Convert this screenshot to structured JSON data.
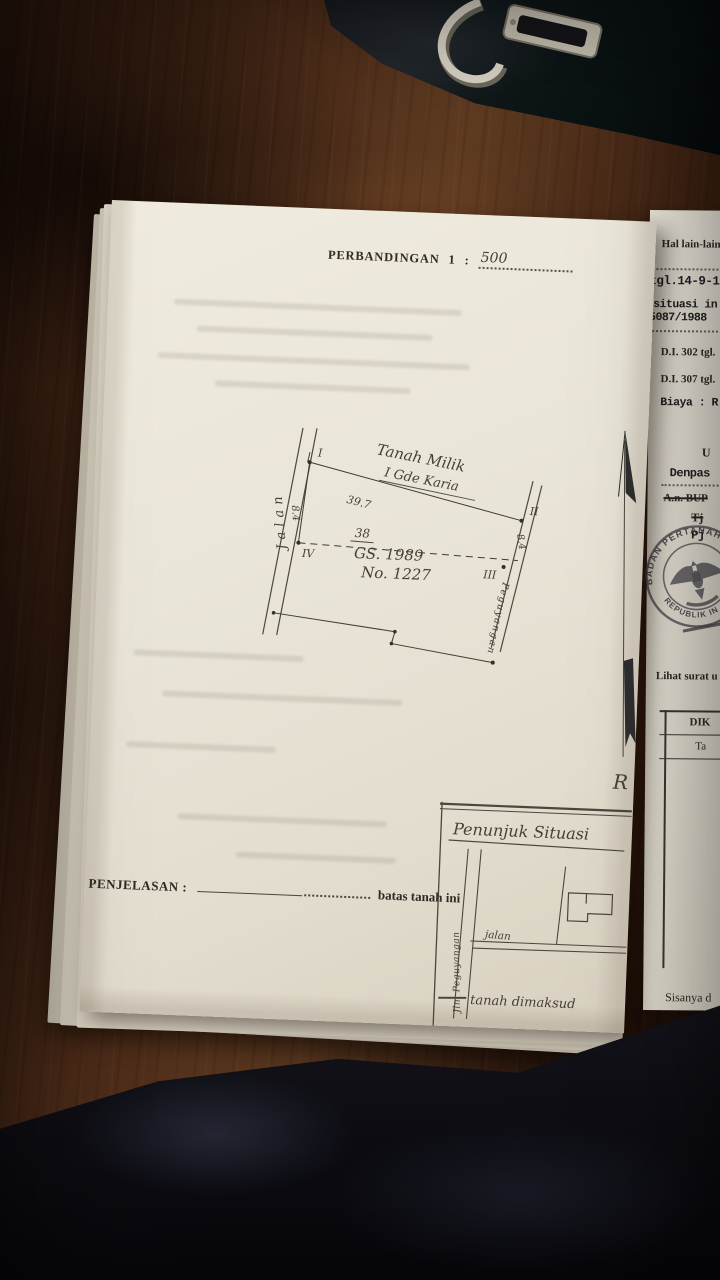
{
  "main_page": {
    "scale": {
      "label": "PERBANDINGAN",
      "ratio": "1",
      "colon": ":",
      "value": "500"
    },
    "sketch": {
      "road_label": "Jalan",
      "owner_line1": "Tanah Milik",
      "owner_line2": "I Gde Karia",
      "dim_top": "39.7",
      "dim_left": "8.4",
      "dim_mid": "38",
      "dim_right": "8.4",
      "ref_line1": "GS. 1989",
      "ref_line2": "No. 1227",
      "corner_1": "I",
      "corner_2": "II",
      "corner_3": "III",
      "corner_4": "IV",
      "right_edge_label": "Peguyangan"
    },
    "north_mark": "R",
    "penjelasan": {
      "label": "PENJELASAN :",
      "value": "batas tanah ini"
    },
    "inset": {
      "title": "Penunjuk Situasi",
      "vertical_road": "Jln. Peguyangan",
      "horizontal_road": "jalan",
      "caption": "tanah dimaksud"
    }
  },
  "right_page": {
    "hal_lain": "Hal lain-lain :",
    "line_tgl": "tgl.14-9-19",
    "line_situasi": "situasi in",
    "line_nomor": "5087/1988",
    "di_302": "D.I. 302 tgl.",
    "di_307": "D.I. 307 tgl.",
    "biaya": "Biaya : R",
    "frag_u": "U",
    "denpasar": "Denpas",
    "struck_1": "A.n. BUP",
    "struck_2": "Tj",
    "pj": "Pj",
    "stamp": {
      "arc_top": "BADAN PERTANAHAN",
      "arc_bottom": "REPUBLIK IN"
    },
    "lihat": "Lihat surat u",
    "table_header_1": "DIK",
    "table_header_2": "Ta",
    "sisanya": "Sisanya d"
  },
  "colors": {
    "paper": "#eae5d9",
    "ink": "#2b2925",
    "pencil": "#4a443b",
    "stamp_ink": "#45444b",
    "wood": "#4a2b18"
  }
}
